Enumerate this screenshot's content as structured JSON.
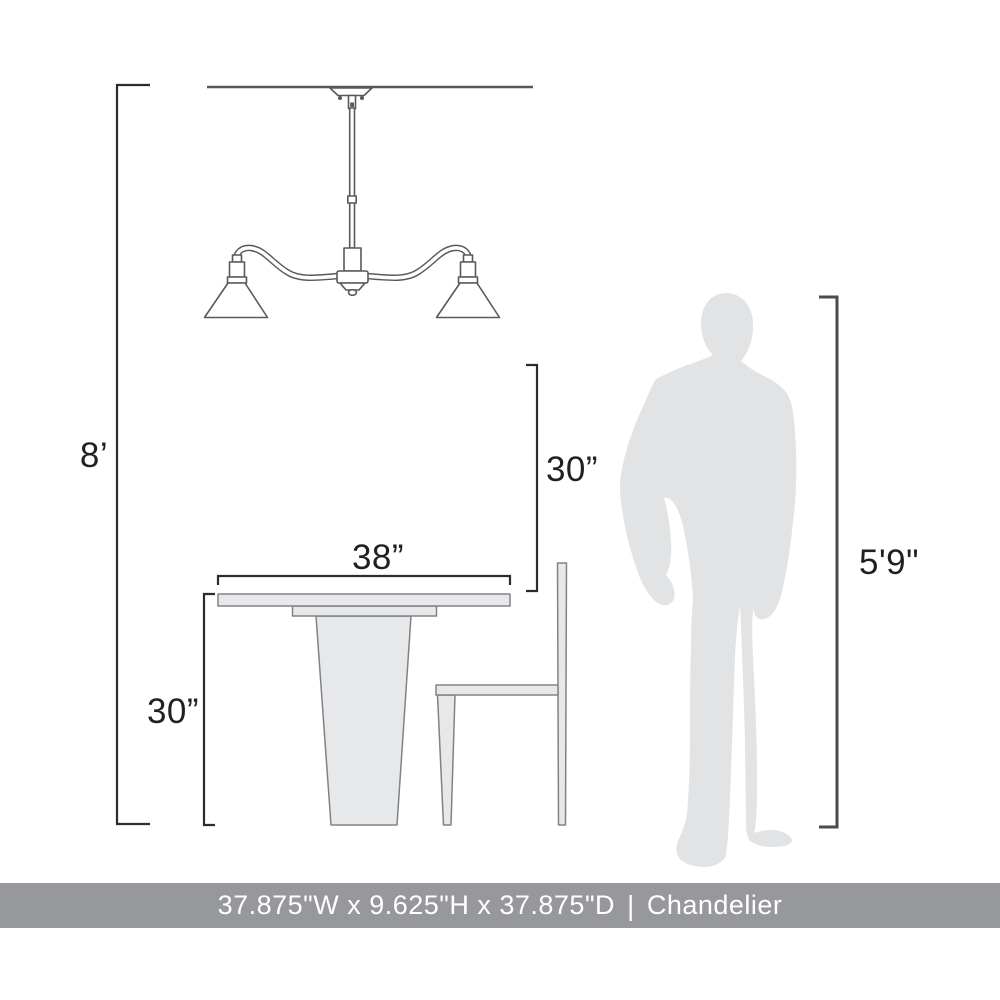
{
  "colors": {
    "background": "#ffffff",
    "line": "#58595b",
    "dim_line": "#2b2c2e",
    "person_dim_line": "#4a4b4d",
    "furniture_fill": "#e7e8ea",
    "furniture_stroke": "#808285",
    "silhouette_fill": "#e2e3e5",
    "bar_bg": "#96989b",
    "bar_text": "#ffffff",
    "label_text": "#231f20"
  },
  "labels": {
    "ceiling_height": "8’",
    "table_width": "38”",
    "hang_clearance": "30”",
    "table_height": "30”",
    "person_height": "5'9\""
  },
  "footer": {
    "dimensions": "37.875\"W x 9.625\"H x 37.875\"D",
    "separator": "|",
    "product_name": "Chandelier"
  }
}
